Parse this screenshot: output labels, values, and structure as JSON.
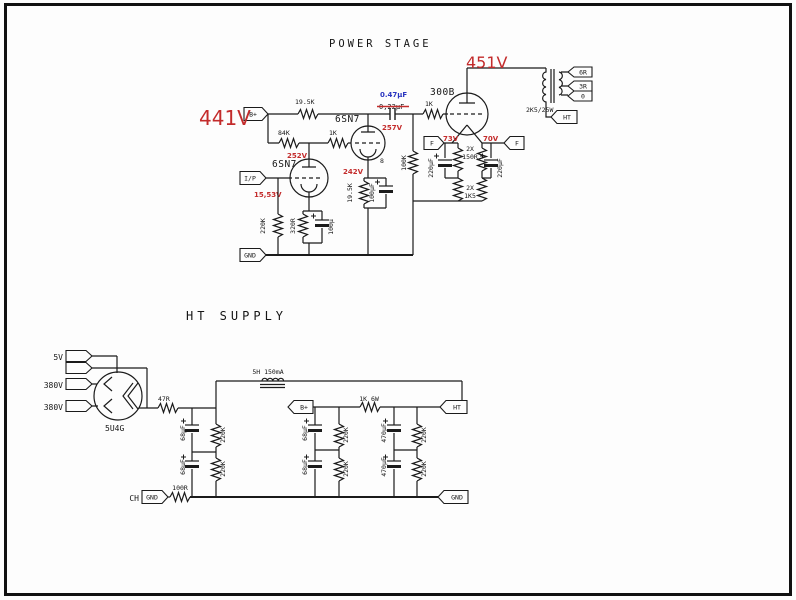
{
  "colors": {
    "line": "#1b1b1b",
    "red_annotation": "#c32b2b",
    "blue_annotation": "#2a35c0",
    "background": "#fdfdfd"
  },
  "power_stage": {
    "title": "POWER STAGE",
    "flags": {
      "b_plus": "B+",
      "input": "I/P",
      "gnd": "GND",
      "filament": "F",
      "sec_6r": "6R",
      "sec_3r": "3R",
      "sec_0": "0",
      "ht": "HT"
    },
    "tubes": {
      "driver": "6SN7",
      "output": "300B",
      "pin8": "8"
    },
    "values": {
      "r_plate2": "19.5K",
      "r_plate1": "84K",
      "r_grid2": "1K",
      "r_gridstop": "1K",
      "c_couple_new": "0.47µF",
      "c_couple_old": "0,22µF",
      "r_gridleak1": "220K",
      "r_cathode1": "320R",
      "c_cathode1": "100µ",
      "r_cathode2": "19.5K",
      "c_cathode2": "100µF",
      "r_gridleak3": "100K",
      "fil_r_qty": "2X",
      "fil_r": "150R",
      "fil_cap": "220µF",
      "hum_r_qty": "2X",
      "hum_r": "1K5",
      "xfmr_primary": "2K5/25W"
    },
    "annotations": {
      "v441": "441V",
      "v451": "451V",
      "v252": "252V",
      "v257": "257V",
      "v242": "242V",
      "v1553": "15,53V",
      "v73": "73V",
      "v70": "70V"
    }
  },
  "ht_supply": {
    "title": "HT SUPPLY",
    "flags": {
      "b_plus": "B+",
      "ht": "HT",
      "gnd": "GND",
      "chassis_gnd": "GND",
      "chassis": "CH"
    },
    "tube": {
      "rectifier": "5U4G"
    },
    "values": {
      "v5": "5V",
      "v380": "380V",
      "r_in": "47R",
      "choke": "5H 150mA",
      "r_drop": "1K 6W",
      "c_68": "68µF",
      "c_470": "470µF",
      "r_bleed": "220K",
      "r_gnd": "100R"
    }
  }
}
